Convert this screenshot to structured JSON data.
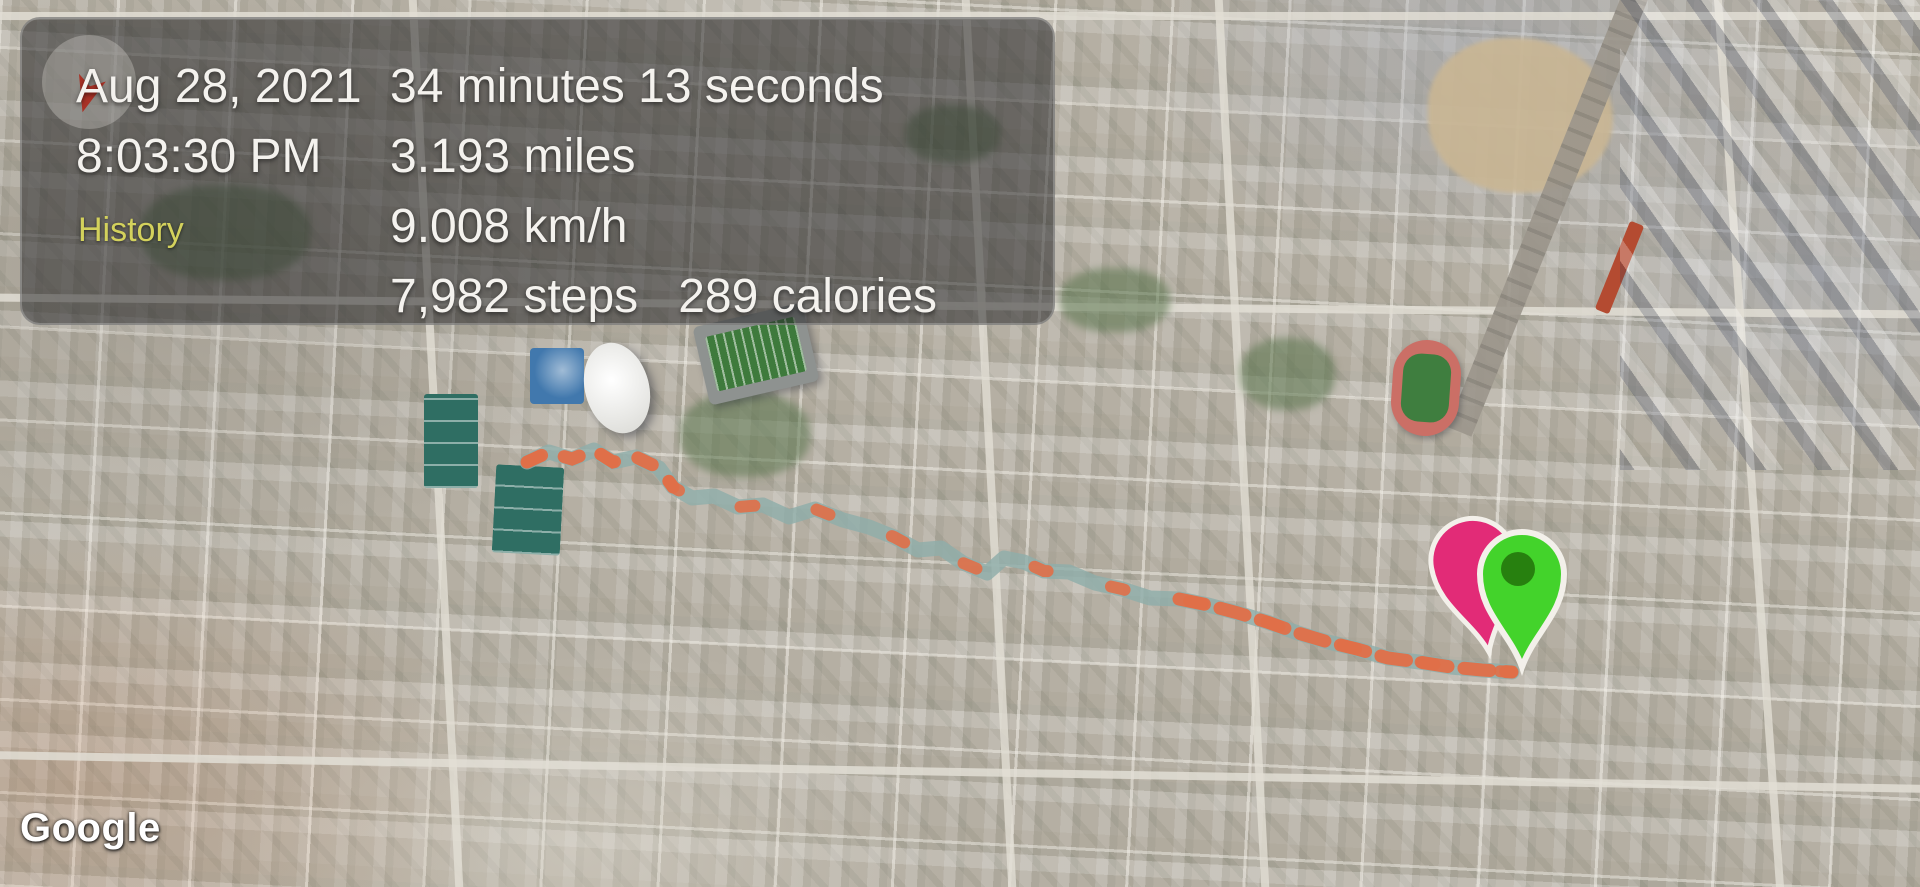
{
  "info_panel": {
    "date": "Aug 28, 2021",
    "time": "8:03:30 PM",
    "history_label": "History",
    "duration": "34 minutes 13 seconds",
    "distance": "3.193 miles",
    "speed": "9.008 km/h",
    "steps": "7,982 steps",
    "calories": "289 calories",
    "text_color": "#f4f2ee",
    "history_color": "#d3d15c",
    "panel_bg": "rgba(40,40,42,0.54)"
  },
  "map": {
    "attribution": "Google",
    "type": "satellite"
  },
  "icons": {
    "compass": "compass-icon",
    "start_marker": "pink-pin-icon",
    "end_marker": "green-pin-icon"
  },
  "route": {
    "color_primary": "#8fadaa",
    "color_secondary": "#e06f48",
    "full_dash": "14 66",
    "segments": [
      {
        "from": 0,
        "to": 8,
        "dash": "16 24"
      },
      {
        "from": 28,
        "to": 40,
        "dash": "26 16"
      }
    ],
    "points": [
      [
        527,
        462
      ],
      [
        549,
        452
      ],
      [
        572,
        459
      ],
      [
        594,
        450
      ],
      [
        613,
        462
      ],
      [
        636,
        457
      ],
      [
        659,
        468
      ],
      [
        673,
        487
      ],
      [
        692,
        498
      ],
      [
        714,
        496
      ],
      [
        738,
        507
      ],
      [
        763,
        505
      ],
      [
        789,
        517
      ],
      [
        815,
        509
      ],
      [
        843,
        520
      ],
      [
        869,
        527
      ],
      [
        894,
        537
      ],
      [
        918,
        550
      ],
      [
        941,
        548
      ],
      [
        963,
        563
      ],
      [
        987,
        573
      ],
      [
        1004,
        558
      ],
      [
        1024,
        562
      ],
      [
        1044,
        571
      ],
      [
        1069,
        572
      ],
      [
        1095,
        583
      ],
      [
        1122,
        589
      ],
      [
        1150,
        598
      ],
      [
        1179,
        599
      ],
      [
        1208,
        605
      ],
      [
        1238,
        613
      ],
      [
        1267,
        622
      ],
      [
        1298,
        633
      ],
      [
        1328,
        642
      ],
      [
        1357,
        649
      ],
      [
        1388,
        658
      ],
      [
        1419,
        662
      ],
      [
        1451,
        667
      ],
      [
        1482,
        670
      ],
      [
        1512,
        672
      ]
    ]
  },
  "markers": [
    {
      "label": "pink-pin",
      "color": "#e22b77",
      "x": 1489,
      "y": 652,
      "rotate": -10
    },
    {
      "label": "green-pin",
      "color": "#43d32b",
      "inner_color": "#27800f",
      "x": 1522,
      "y": 667,
      "rotate": 0
    }
  ]
}
